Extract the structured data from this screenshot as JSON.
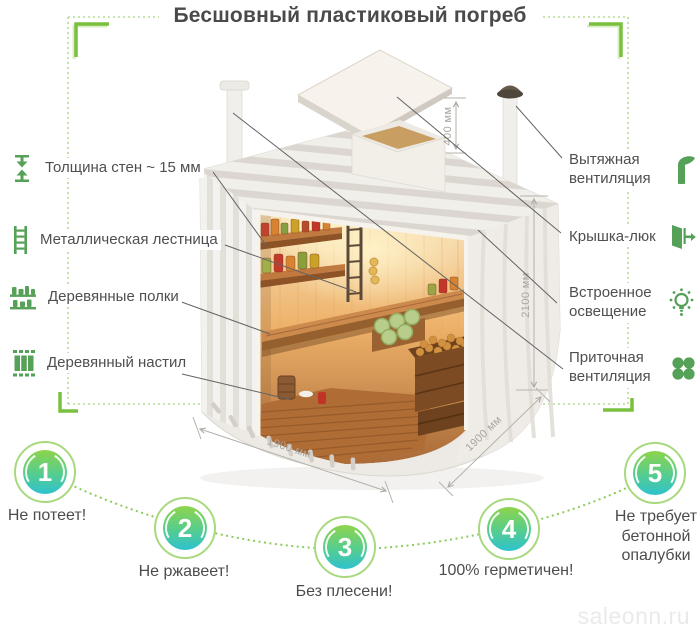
{
  "title": "Бесшовный пластиковый погреб",
  "left_labels": [
    {
      "icon": "wall-thickness-icon",
      "text": "Толщина стен ~ 15 мм"
    },
    {
      "icon": "metal-ladder-icon",
      "text": "Металлическая лестница"
    },
    {
      "icon": "wooden-shelves-icon",
      "text": "Деревянные полки"
    },
    {
      "icon": "wooden-floor-icon",
      "text": "Деревянный настил"
    }
  ],
  "right_labels": [
    {
      "icon": "exhaust-vent-icon",
      "text": "Вытяжная вентиляция"
    },
    {
      "icon": "hatch-lid-icon",
      "text": "Крышка-люк"
    },
    {
      "icon": "built-in-light-icon",
      "text": "Встроенное освещение"
    },
    {
      "icon": "supply-vent-icon",
      "text": "Приточная вентиляция"
    }
  ],
  "dimensions": {
    "hatch_neck_height": "400 мм",
    "body_height": "2100 мм",
    "body_depth": "1900 мм",
    "body_width": "1900 мм"
  },
  "features": [
    {
      "number": "1",
      "text": "Не потеет!"
    },
    {
      "number": "2",
      "text": "Не ржавеет!"
    },
    {
      "number": "3",
      "text": "Без плесени!"
    },
    {
      "number": "4",
      "text": "100% герметичен!"
    },
    {
      "number": "5",
      "text": "Не требует бетонной опалубки"
    }
  ],
  "watermark": "saleonn.ru",
  "colors": {
    "accent_green": "#76c13d",
    "dotted_green": "#b6db97",
    "icon_green": "#55a157",
    "badge_ring": "#a9d97e",
    "badge_gradient_top": "#8ed44c",
    "badge_gradient_bottom": "#2ec2cf",
    "text_dark": "#4b4b4b",
    "dimension_gray": "#a8a49e",
    "watermark_gray": "#eaeaea"
  }
}
